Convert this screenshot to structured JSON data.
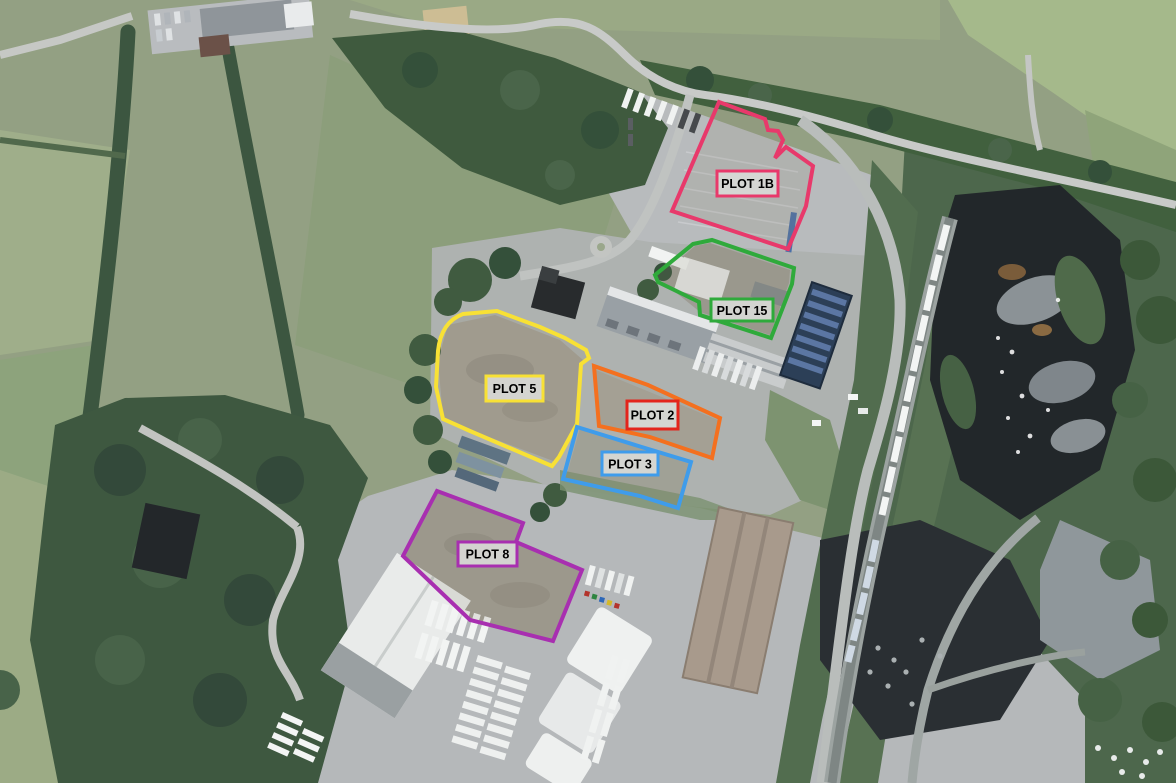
{
  "map": {
    "label_text_color": "#000000",
    "plots": [
      {
        "name": "PLOT 1B",
        "outline_color": "#e8396b",
        "label_border_color": "#e8396b"
      },
      {
        "name": "PLOT 15",
        "outline_color": "#2faa3b",
        "label_border_color": "#2faa3b"
      },
      {
        "name": "PLOT 5",
        "outline_color": "#f8e135",
        "label_border_color": "#f8e135"
      },
      {
        "name": "PLOT 2",
        "outline_color": "#f4701f",
        "label_border_color": "#e3241b"
      },
      {
        "name": "PLOT 3",
        "outline_color": "#3f9ceb",
        "label_border_color": "#3f9ceb"
      },
      {
        "name": "PLOT 8",
        "outline_color": "#a82fb0",
        "label_border_color": "#a82fb0"
      }
    ]
  }
}
